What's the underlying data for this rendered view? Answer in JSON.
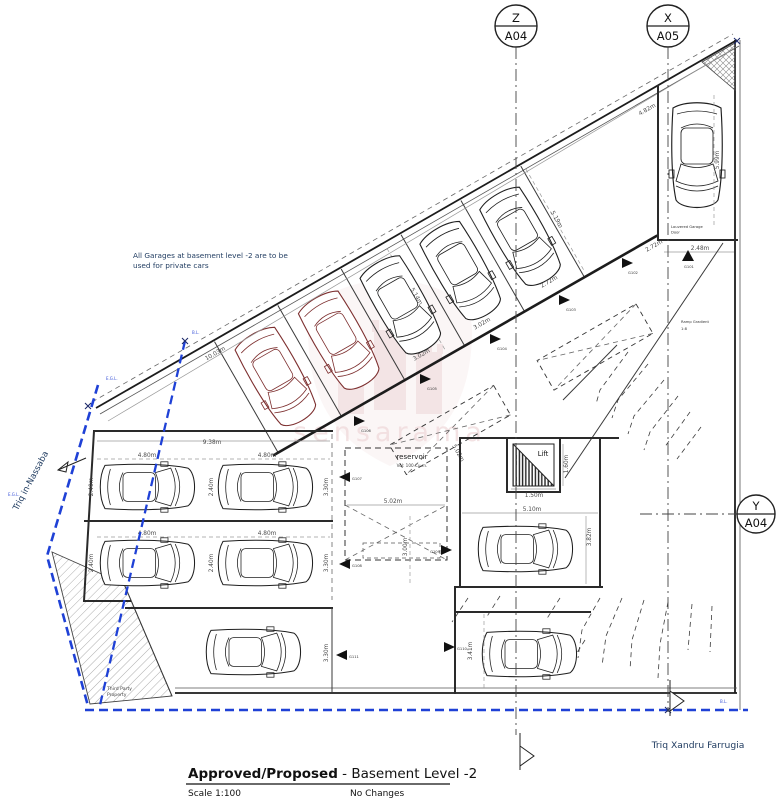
{
  "title_block": {
    "title_bold": "Approved/Proposed",
    "title_rest": " - Basement Level -2",
    "scale": "Scale 1:100",
    "changes": "No Changes"
  },
  "markers": {
    "z_letter": "Z",
    "z_code": "A04",
    "x_letter": "X",
    "x_code": "A05",
    "y_letter": "Y",
    "y_code": "A04"
  },
  "streets": {
    "left": "Triq in-Nassaba",
    "bottom": "Triq Xandru Farrugia"
  },
  "notes": {
    "garages_line1": "All Garages at basement level -2 are to be",
    "garages_line2": "used for private cars",
    "third_party_line1": "Third Party",
    "third_party_line2": "Property",
    "louvered_line1": "Louvered Garage",
    "louvered_line2": "Door",
    "ramp_line1": "Ramp Gradient",
    "ramp_line2": "1:8",
    "reservoir": "reservoir",
    "reservoir_vol": "Vol: 100 Cu.m.",
    "lift": "Lift",
    "egl": "E.G.L.",
    "bl": "B.L."
  },
  "dims": {
    "boundary_seg": "10.03m",
    "boundary_end": "4.82m",
    "block_width": "9.38m",
    "stall_width": "4.80m",
    "stall_depth": "2.40m",
    "stall_front": "3.30m",
    "reservoir_width": "5.02m",
    "void_stall": "5.02m",
    "room_width": "5.10m",
    "diag_depth_a": "5.14m",
    "diag_depth_b": "5.19m",
    "diag_width_a": "3.02m",
    "diag_width_b": "2.72m",
    "end_stall_depth": "5.99m",
    "end_stall_width": "2.48m",
    "lift_width": "1.50m",
    "lift_depth": "1.60m",
    "room_depth": "3.00m",
    "room_height": "3.82m",
    "lower_stall": "3.41m"
  },
  "garages": {
    "g101": "G101",
    "g102": "G102",
    "g103": "G103",
    "g104": "G104",
    "g105": "G105",
    "g106": "G106",
    "g107": "G107",
    "g108": "G108",
    "g109": "G109",
    "g110": "G110",
    "g111": "G111"
  },
  "watermark": {
    "text": "sensarama"
  },
  "colors": {
    "boundary_blue": "#1f41d6",
    "note_navy": "#1e3a5f",
    "car_red": "#7d2f2f",
    "watermark_pink": "#d49a9e"
  }
}
